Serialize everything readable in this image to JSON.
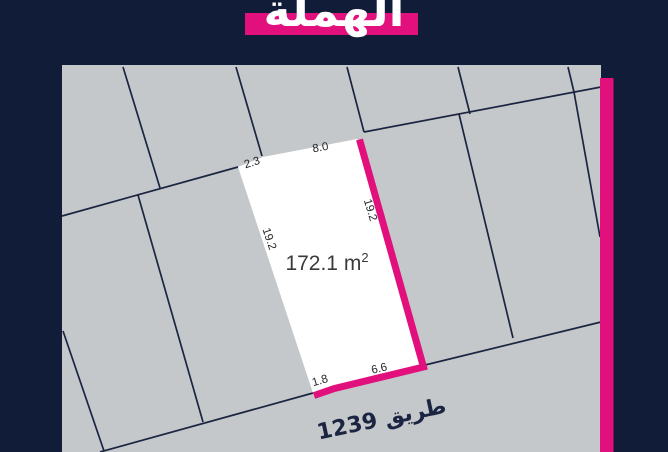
{
  "header": {
    "title": "الهملة"
  },
  "map": {
    "plot": {
      "area_value": "172.1 m",
      "area_superscript": "2",
      "dimensions": {
        "top_left": "2.3",
        "top": "8.0",
        "left": "19.2",
        "right": "19.2",
        "bottom_left": "1.8",
        "bottom_right": "6.6"
      }
    },
    "road_label": "طريق 1239"
  },
  "colors": {
    "background_navy": "#101c38",
    "accent_pink": "#e2107c",
    "map_gray": "#c5c8ca",
    "line_navy": "#1b2541",
    "plot_white": "#ffffff",
    "area_text": "#3a3a3a",
    "dim_text": "#262626"
  }
}
